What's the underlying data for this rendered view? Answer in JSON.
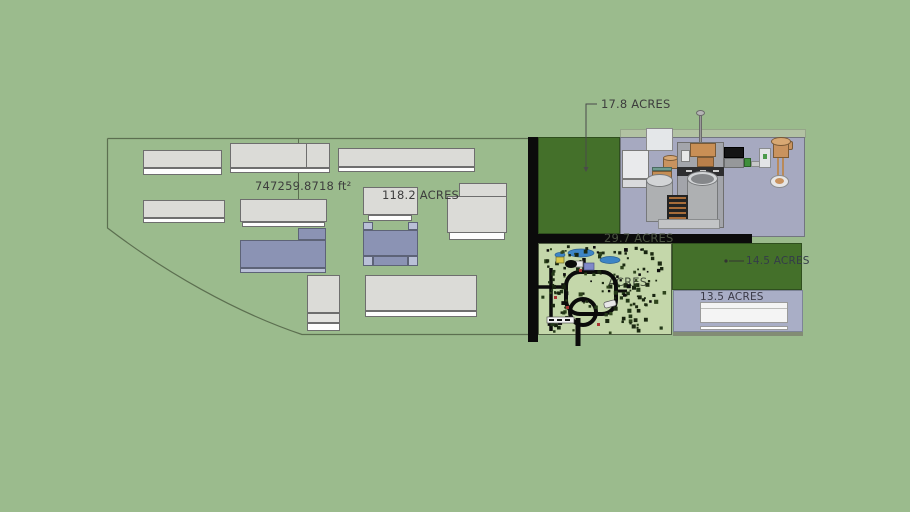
{
  "viewport": {
    "width": 910,
    "height": 512,
    "description": "3D site plan model viewport"
  },
  "zones": [
    {
      "id": "main-site",
      "label": "747259.8718 ft²"
    },
    {
      "id": "center-parcel",
      "label": "118.2 ACRES"
    },
    {
      "id": "north-green",
      "label": "17.8 ACRES"
    },
    {
      "id": "road-band",
      "label": "29.7 ACRES"
    },
    {
      "id": "landscape",
      "label": "ACRES"
    },
    {
      "id": "east-green",
      "label": "14.5 ACRES"
    },
    {
      "id": "southeast-lot",
      "label": "13.5 ACRES"
    }
  ],
  "colors": {
    "background": "#9bbb8d",
    "parcel_dark_green": "#44702a",
    "plant_ground": "#a6a9c0",
    "lavender_parcel": "#a9aec6",
    "landscape_ground": "#c4d7aa",
    "road_black": "#0b0b0b",
    "building_gray": "#dbdbd7",
    "building_white": "#fdfdfd",
    "building_blue": "#8b93b4",
    "tank_tan": "#c9935f",
    "pond_blue": "#3d85c6",
    "label_text": "#3d3d3d"
  }
}
